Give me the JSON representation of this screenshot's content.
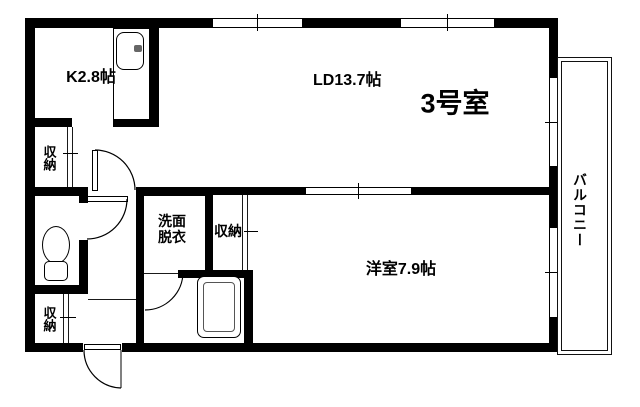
{
  "floorplan": {
    "unit_label": "3号室",
    "labels": {
      "kitchen": "K2.8帖",
      "living_dining": "LD13.7帖",
      "western_room": "洋室7.9帖",
      "washroom_line1": "洗面",
      "washroom_line2": "脱衣",
      "storage_upper": "収納",
      "storage_mid": "収納",
      "storage_lower": "収納",
      "balcony": "バルコニー"
    },
    "colors": {
      "wall": "#000000",
      "line": "#1a1a1a",
      "background": "#ffffff"
    }
  }
}
